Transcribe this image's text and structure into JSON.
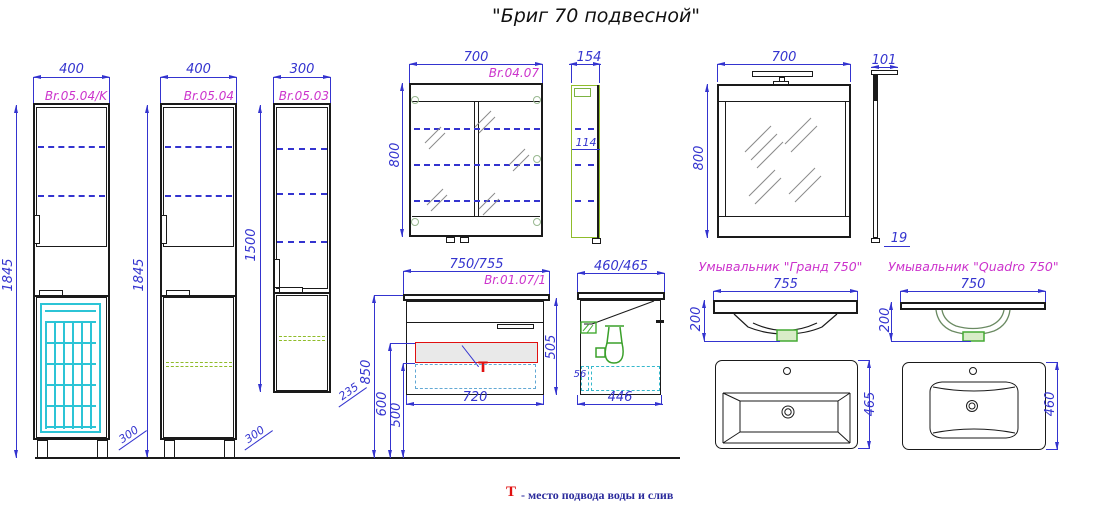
{
  "title": "\"Бриг 70 подвесной\"",
  "cab1": {
    "w": "400",
    "art": "Br.05.04/K",
    "h": "1845",
    "leg": "300"
  },
  "cab2": {
    "w": "400",
    "art": "Br.05.04",
    "h": "1845",
    "leg": "300"
  },
  "cab3": {
    "w": "300",
    "art": "Br.05.03",
    "h": "1500",
    "leg": "235"
  },
  "mcab": {
    "w": "700",
    "art": "Br.04.07",
    "h": "800",
    "d": "154",
    "d2": "114"
  },
  "mirror": {
    "w": "700",
    "art": "Br.02.07",
    "h": "800",
    "top": "101",
    "bot": "19"
  },
  "vanity": {
    "w": "750/755",
    "art": "Br.01.07/1",
    "h": "505",
    "bw": "720",
    "m850": "850",
    "m600": "600",
    "m500": "500",
    "t": "T"
  },
  "vside": {
    "w": "460/465",
    "bw": "446",
    "s": "56"
  },
  "grand": {
    "title": "Умывальник \"Гранд 750\"",
    "w": "755",
    "h": "200",
    "d": "465"
  },
  "quadro": {
    "title": "Умывальник \"Quadro 750\"",
    "w": "750",
    "h": "200",
    "d": "460"
  },
  "legend": {
    "t": "T",
    "text": "- место подвода воды и слив"
  },
  "colors": {
    "dim": "#3434cf",
    "art": "#cc33cc",
    "red": "#e01010",
    "green": "#44aa33",
    "green2": "#8fbc2a",
    "cyan": "#2cc4d6",
    "cyan2": "#35b8cc",
    "lblue": "#62a8d4",
    "ink": "#1a1a1a"
  }
}
